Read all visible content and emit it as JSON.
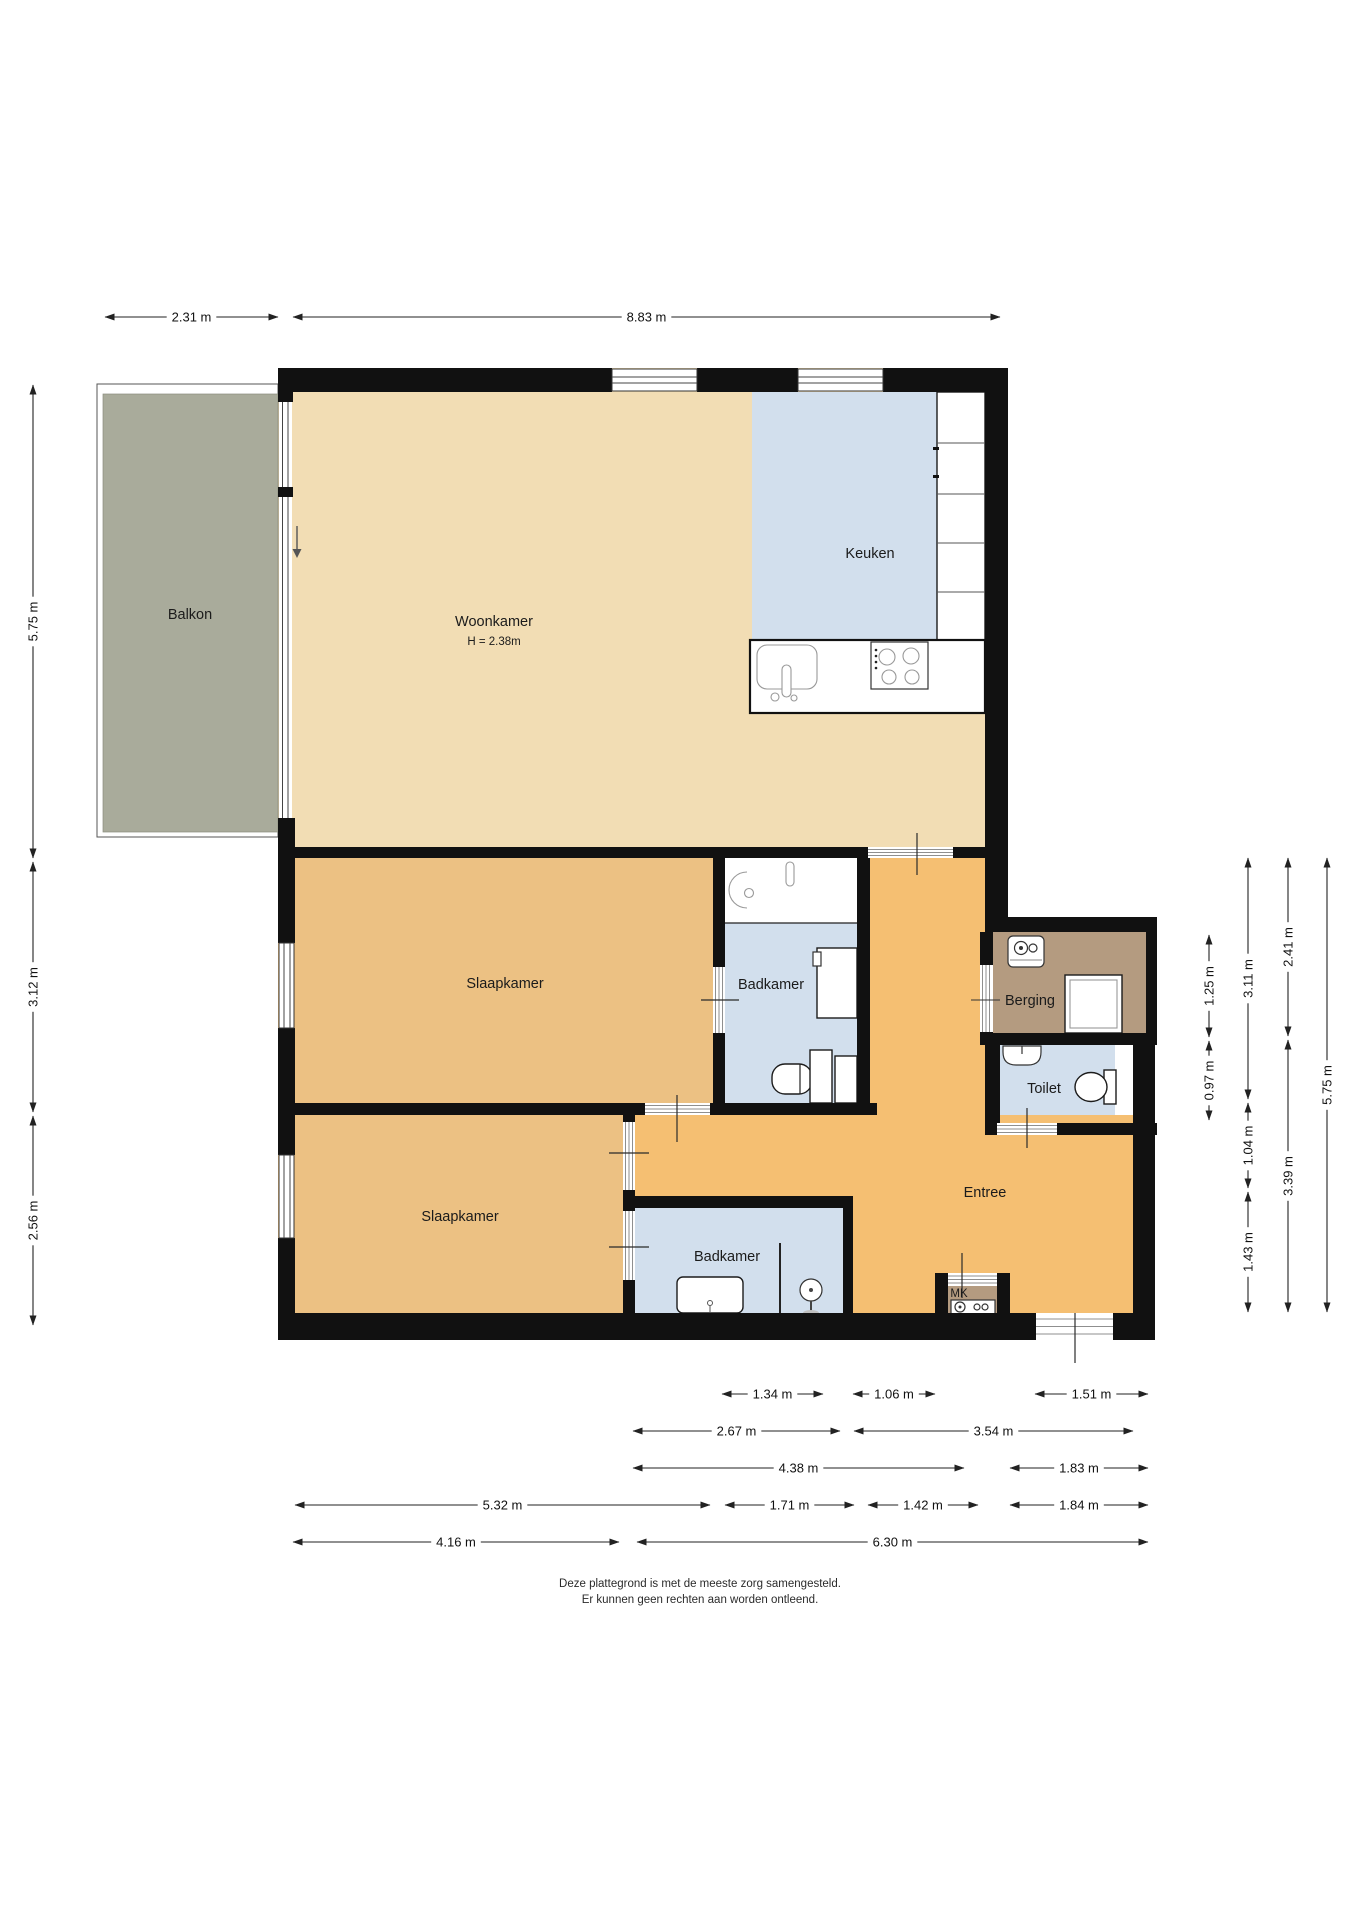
{
  "colors": {
    "wall": "#111111",
    "woonkamer": "#f2ddb4",
    "slaapkamer": "#ecc183",
    "entree": "#f5bf72",
    "natte_ruimte": "#d2dfed",
    "balkon": "#a9ab9b",
    "berging": "#b49b80"
  },
  "rooms": {
    "balkon": {
      "label": "Balkon"
    },
    "woonkamer": {
      "label": "Woonkamer",
      "height_note": "H = 2.38m"
    },
    "keuken": {
      "label": "Keuken"
    },
    "slaapkamer1": {
      "label": "Slaapkamer"
    },
    "badkamer1": {
      "label": "Badkamer"
    },
    "berging": {
      "label": "Berging"
    },
    "toilet": {
      "label": "Toilet"
    },
    "entree": {
      "label": "Entree"
    },
    "slaapkamer2": {
      "label": "Slaapkamer"
    },
    "badkamer2": {
      "label": "Badkamer"
    },
    "meterkast": {
      "label": "MK"
    }
  },
  "fixtures": [
    "kitchen-sink",
    "stove-4-burner",
    "kitchen-cabinets",
    "washbasin",
    "shower-cabin",
    "toilet-bowl",
    "corner-basin",
    "boiler",
    "washing-machine",
    "shower-head",
    "meter-box",
    "entry-arrow"
  ],
  "disclaimer": {
    "line1": "Deze plattegrond is met de meeste zorg samengesteld.",
    "line2": "Er kunnen geen rechten aan worden ontleend."
  },
  "dimensions": {
    "top": [
      {
        "label": "2.31 m",
        "x1": 105,
        "x2": 278,
        "y": 317
      },
      {
        "label": "8.83 m",
        "x1": 293,
        "x2": 1000,
        "y": 317
      }
    ],
    "left": [
      {
        "label": "5.75 m",
        "x": 33,
        "y1": 385,
        "y2": 858
      },
      {
        "label": "3.12 m",
        "x": 33,
        "y1": 862,
        "y2": 1112
      },
      {
        "label": "2.56 m",
        "x": 33,
        "y1": 1116,
        "y2": 1325
      }
    ],
    "right": [
      {
        "label": "1.25 m",
        "x": 1209,
        "y1": 935,
        "y2": 1037
      },
      {
        "label": "0.97 m",
        "x": 1209,
        "y1": 1041,
        "y2": 1120
      },
      {
        "label": "3.11 m",
        "x": 1248,
        "y1": 858,
        "y2": 1099
      },
      {
        "label": "1.04 m",
        "x": 1248,
        "y1": 1103,
        "y2": 1188
      },
      {
        "label": "1.43 m",
        "x": 1248,
        "y1": 1192,
        "y2": 1312
      },
      {
        "label": "2.41 m",
        "x": 1288,
        "y1": 858,
        "y2": 1036
      },
      {
        "label": "3.39 m",
        "x": 1288,
        "y1": 1040,
        "y2": 1312
      },
      {
        "label": "5.75 m",
        "x": 1327,
        "y1": 858,
        "y2": 1312
      }
    ],
    "bottom": [
      {
        "label": "1.34 m",
        "x1": 722,
        "x2": 823,
        "y": 1394
      },
      {
        "label": "1.06 m",
        "x1": 853,
        "x2": 935,
        "y": 1394
      },
      {
        "label": "1.51 m",
        "x1": 1035,
        "x2": 1148,
        "y": 1394
      },
      {
        "label": "2.67 m",
        "x1": 633,
        "x2": 840,
        "y": 1431
      },
      {
        "label": "3.54 m",
        "x1": 854,
        "x2": 1133,
        "y": 1431
      },
      {
        "label": "4.38 m",
        "x1": 633,
        "x2": 964,
        "y": 1468
      },
      {
        "label": "1.83 m",
        "x1": 1010,
        "x2": 1148,
        "y": 1468
      },
      {
        "label": "5.32 m",
        "x1": 295,
        "x2": 710,
        "y": 1505
      },
      {
        "label": "1.71 m",
        "x1": 725,
        "x2": 854,
        "y": 1505
      },
      {
        "label": "1.42 m",
        "x1": 868,
        "x2": 978,
        "y": 1505
      },
      {
        "label": "1.84 m",
        "x1": 1010,
        "x2": 1148,
        "y": 1505
      },
      {
        "label": "4.16 m",
        "x1": 293,
        "x2": 619,
        "y": 1542
      },
      {
        "label": "6.30 m",
        "x1": 637,
        "x2": 1148,
        "y": 1542
      }
    ]
  }
}
